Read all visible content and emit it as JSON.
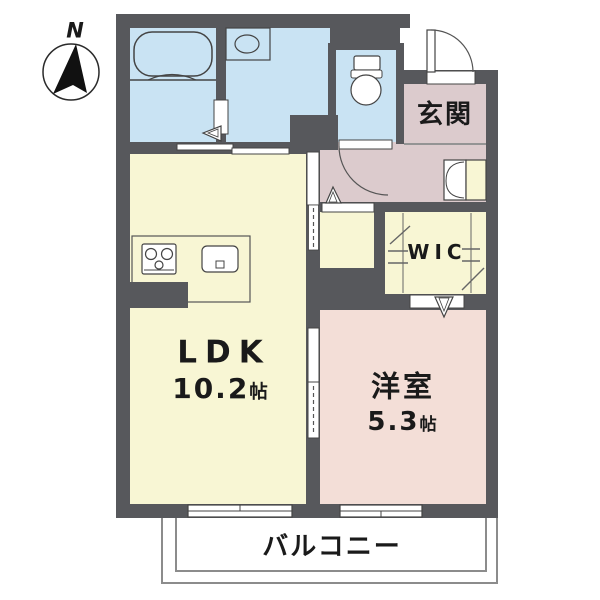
{
  "compass": {
    "north_label": "N"
  },
  "rooms": {
    "entrance": {
      "label": "玄関"
    },
    "walk_in_closet": {
      "label": "WIC"
    },
    "ldk": {
      "label": "LDK",
      "area": "10.2",
      "area_unit": "帖"
    },
    "western_room": {
      "label": "洋室",
      "area": "5.3",
      "area_unit": "帖"
    },
    "balcony": {
      "label": "バルコニー"
    }
  },
  "palette": {
    "wall": "#57585c",
    "wet_area_fill": "#c9e3f3",
    "ldk_fill": "#f8f6d4",
    "entrance_hall_fill": "#dccbcd",
    "western_room_fill": "#f3ded7",
    "outline": "#444444",
    "balcony_line": "#8c8c8c",
    "text": "#1a1a1a"
  },
  "fixtures": [
    "compass-north-icon",
    "bathtub-icon",
    "washbasin-icon",
    "toilet-icon",
    "stove-icon",
    "kitchen-sink-icon",
    "shoe-cabinet-icon",
    "hanger-pipe-icon",
    "door-swing-icon",
    "sliding-door-icon",
    "folding-door-icon",
    "window-icon"
  ]
}
